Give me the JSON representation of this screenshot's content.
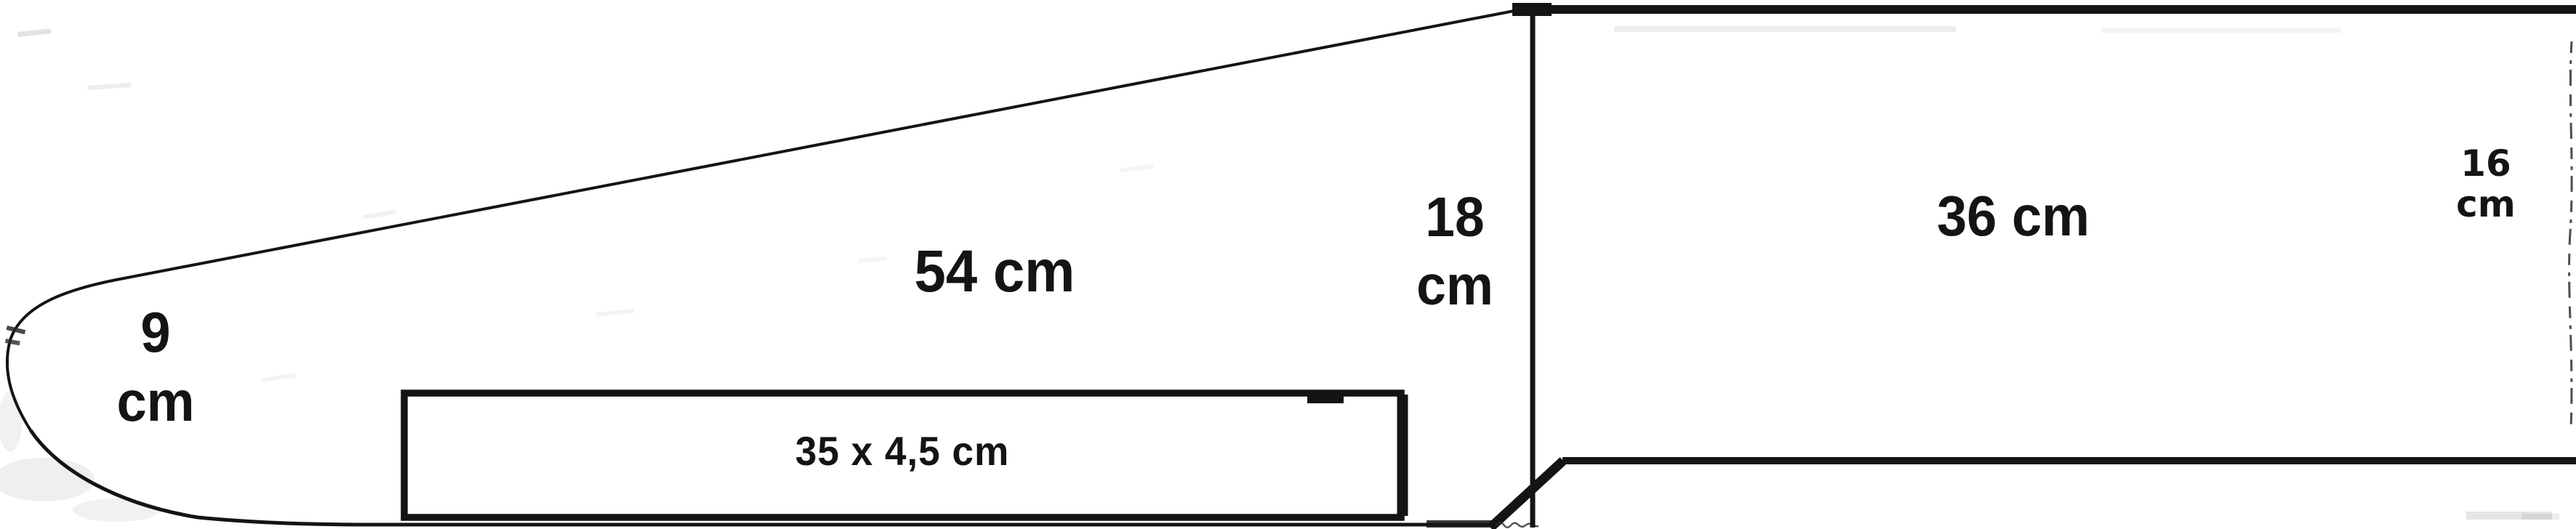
{
  "diagram": {
    "labels": {
      "tip_height": {
        "line1": "9",
        "line2": "cm"
      },
      "flap_length": {
        "text": "54 cm"
      },
      "slot_size": {
        "text": "35 x 4,5 cm"
      },
      "left_height": {
        "line1": "18",
        "line2": "cm"
      },
      "panel_length": {
        "text": "36 cm"
      },
      "right_height": {
        "line1": "16",
        "line2": "cm"
      }
    },
    "colors": {
      "ink": "#141414",
      "background": "#ffffff"
    }
  }
}
